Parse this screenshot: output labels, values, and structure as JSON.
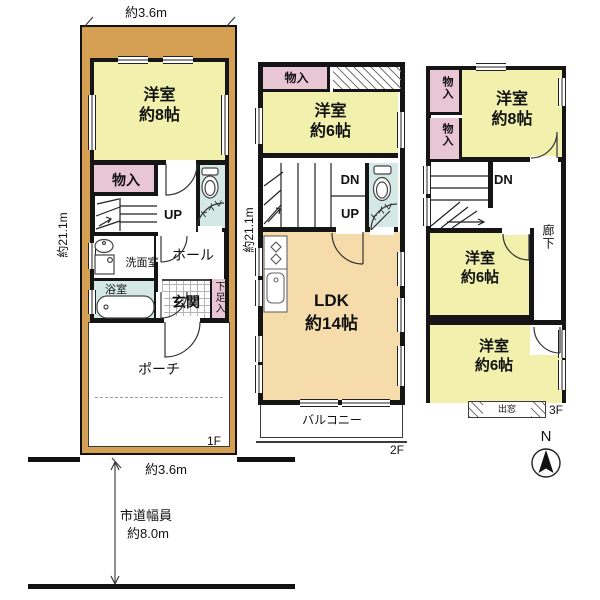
{
  "floor1": {
    "floor_label": "1F",
    "dim_top": "約3.6m",
    "dim_left": "約21.1m",
    "bedroom_name": "洋室",
    "bedroom_size": "約8帖",
    "storage": "物入",
    "stairs_up": "UP",
    "toilet": "トイレ",
    "hall": "ホール",
    "washroom": "洗面室",
    "bathroom": "浴室",
    "entrance": "玄関",
    "shoe_cabinet": "下足入",
    "porch": "ポーチ"
  },
  "floor2": {
    "floor_label": "2F",
    "dim_left": "約21.1m",
    "storage": "物入",
    "bedroom_name": "洋室",
    "bedroom_size": "約6帖",
    "stairs_down": "DN",
    "stairs_up": "UP",
    "toilet": "トイレ",
    "ldk_name": "LDK",
    "ldk_size": "約14帖",
    "balcony": "バルコニー"
  },
  "floor3": {
    "floor_label": "3F",
    "storage_a": "物入",
    "storage_b": "物入",
    "bedroom8_name": "洋室",
    "bedroom8_size": "約8帖",
    "stairs_down": "DN",
    "corridor": "廊下",
    "bedroom6a_name": "洋室",
    "bedroom6a_size": "約6帖",
    "bedroom6b_name": "洋室",
    "bedroom6b_size": "約6帖",
    "bay_window": "出窓"
  },
  "site": {
    "frontage": "約3.6m",
    "road_type": "市道幅員",
    "road_width": "約8.0m",
    "compass_north": "N"
  },
  "colors": {
    "land": "#d5a054",
    "room_yellow": "#f1f1ad",
    "ldk_orange": "#f6dcab",
    "storage_pink": "#e9c6d3",
    "wet_blue": "#d4e9e5"
  }
}
